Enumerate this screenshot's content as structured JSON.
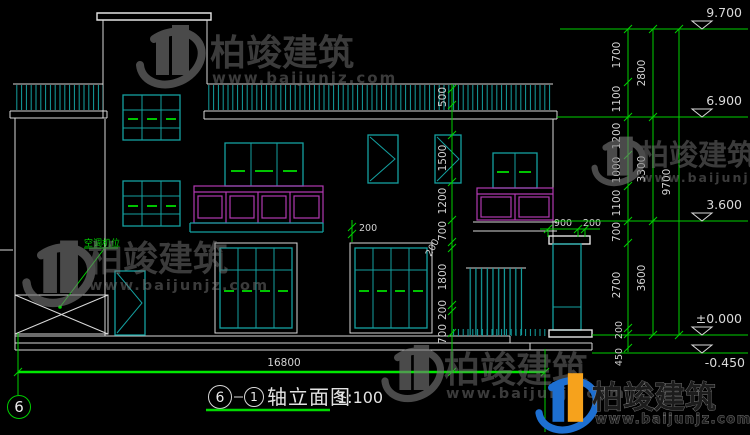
{
  "watermark": {
    "brand": "柏竣建筑",
    "url": "www.baijunjz.com"
  },
  "title_block": {
    "axis_from": "6",
    "axis_to": "1",
    "name": "轴立面图",
    "scale": "1:100"
  },
  "axis": {
    "left_bubble": "6"
  },
  "annotations": {
    "ac_unit": "空调机位",
    "window_offset": "200",
    "chimney_width": "900",
    "chimney_offset": "200",
    "ground_total": "16800"
  },
  "levels": {
    "l9700": "9.700",
    "l6900": "6.900",
    "l3600": "3.600",
    "l0": "±0.000",
    "lm450": "-0.450"
  },
  "dims": {
    "mid": {
      "d500": "500",
      "d1500": "1500",
      "d1200": "1200",
      "d700a": "700",
      "d200a": "200",
      "d1800": "1800",
      "d200b": "200",
      "d700b": "700"
    },
    "right_inner": {
      "d1700": "1700",
      "d1100a": "1100",
      "d1200": "1200",
      "d1000": "1000",
      "d1100b": "1100",
      "d700": "700",
      "d2700": "2700",
      "d200": "200",
      "d450": "450"
    },
    "right_mid": {
      "d2800": "2800",
      "d3300": "3300",
      "d3600": "3600"
    },
    "right_total": "9700"
  },
  "colors": {
    "background": "#000000",
    "line": "#d9d9d9",
    "teal": "#14a0a0",
    "green": "#00cf00",
    "bright_green": "#00e800",
    "magenta": "#b138b1",
    "dim_text": "#d2d2d2",
    "watermark_gray": "#787878",
    "logo_blue": "#1d6fd1",
    "logo_orange": "#f6a21c"
  }
}
